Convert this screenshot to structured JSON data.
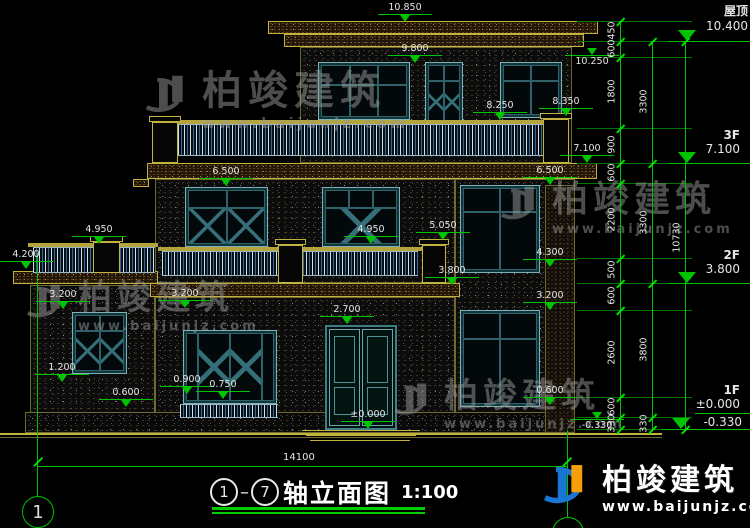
{
  "drawing": {
    "axis_from": "1",
    "axis_to": "7",
    "title": "轴立面图",
    "scale": "1:100",
    "axis_bubble_left": "1"
  },
  "right_levels": [
    {
      "name": "屋顶",
      "value": "10.400"
    },
    {
      "name": "3F",
      "value": "7.100"
    },
    {
      "name": "2F",
      "value": "3.800"
    },
    {
      "name": "1F",
      "value": "±0.000"
    },
    {
      "name": "",
      "value": "-0.330"
    }
  ],
  "spot_levels": [
    "10.850",
    "9.800",
    "10.250",
    "8.250",
    "8.350",
    "7.100",
    "6.500",
    "6.500",
    "4.950",
    "4.950",
    "5.050",
    "4.200",
    "4.300",
    "3.800",
    "3.200",
    "3.200",
    "3.200",
    "2.700",
    "1.200",
    "0.900",
    "0.750",
    "0.600",
    "0.600",
    "±0.000",
    "-0.330"
  ],
  "dim_chains": {
    "inner": [
      "450",
      "600",
      "1800",
      "900",
      "600",
      "2200",
      "500",
      "600",
      "2600",
      "600",
      "330"
    ],
    "middle": [
      "3300",
      "3300",
      "3800",
      "330"
    ],
    "outer": [
      "10730"
    ],
    "width_total": "14100"
  },
  "watermark": {
    "cn": "柏竣建筑",
    "url": "www.baijunjz.com"
  },
  "logo": {
    "cn": "柏竣建筑",
    "url": "www.baijunjz.com"
  }
}
